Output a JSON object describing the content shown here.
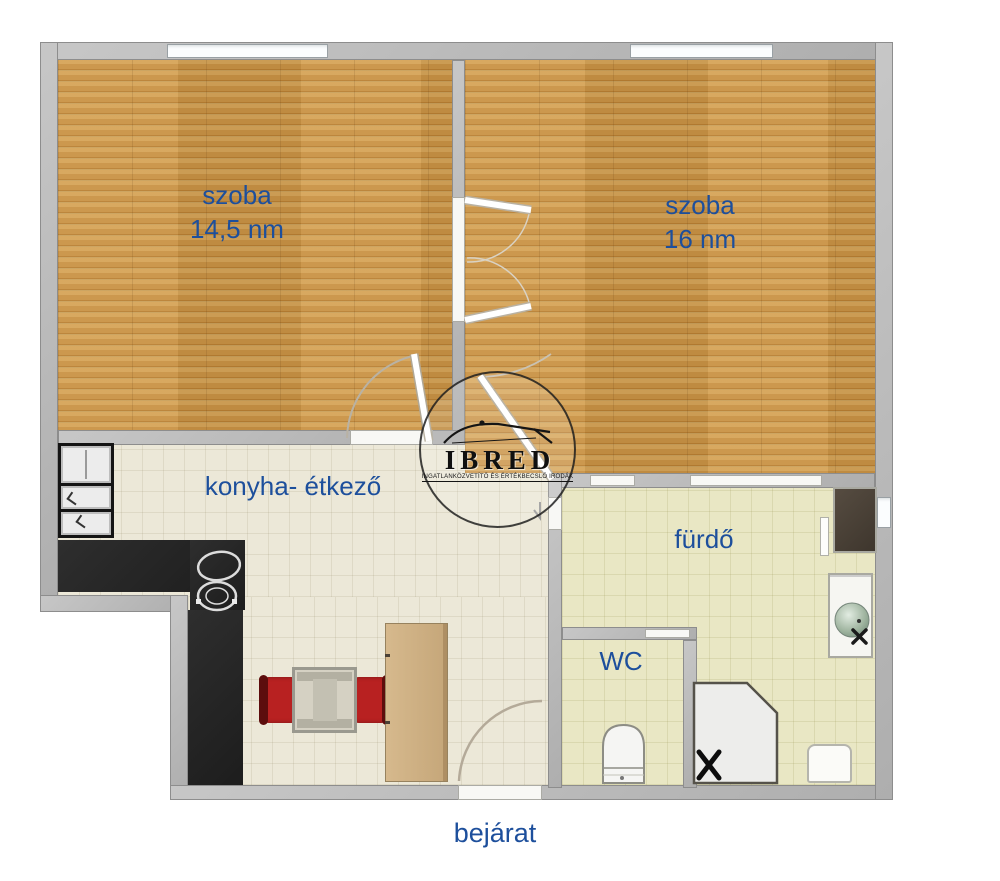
{
  "rooms": {
    "room1": {
      "label": "szoba",
      "area": "14,5 nm"
    },
    "room2": {
      "label": "szoba",
      "area": "16 nm"
    },
    "kitchen": {
      "label": "konyha- étkező"
    },
    "bathroom": {
      "label": "fürdő"
    },
    "wc": {
      "label": "WC"
    },
    "entrance": {
      "label": "bejárat"
    }
  },
  "watermark": {
    "brand": "IBRED",
    "tagline": "INGATLANKÖZVETÍTŐ ÉS ÉRTÉKBECSLŐ IRODÁK"
  },
  "colors": {
    "label_text": "#1d4f9c",
    "wood_floor": "#cd9848",
    "kitchen_floor": "#ece8d8",
    "bath_floor": "#e9e7c4",
    "wall_gray": "#b7b7b7",
    "counter_black": "#262626",
    "chair_red": "#b82121",
    "sideboard_tan": "#cdb187",
    "sink_green": "#9fb49f"
  }
}
